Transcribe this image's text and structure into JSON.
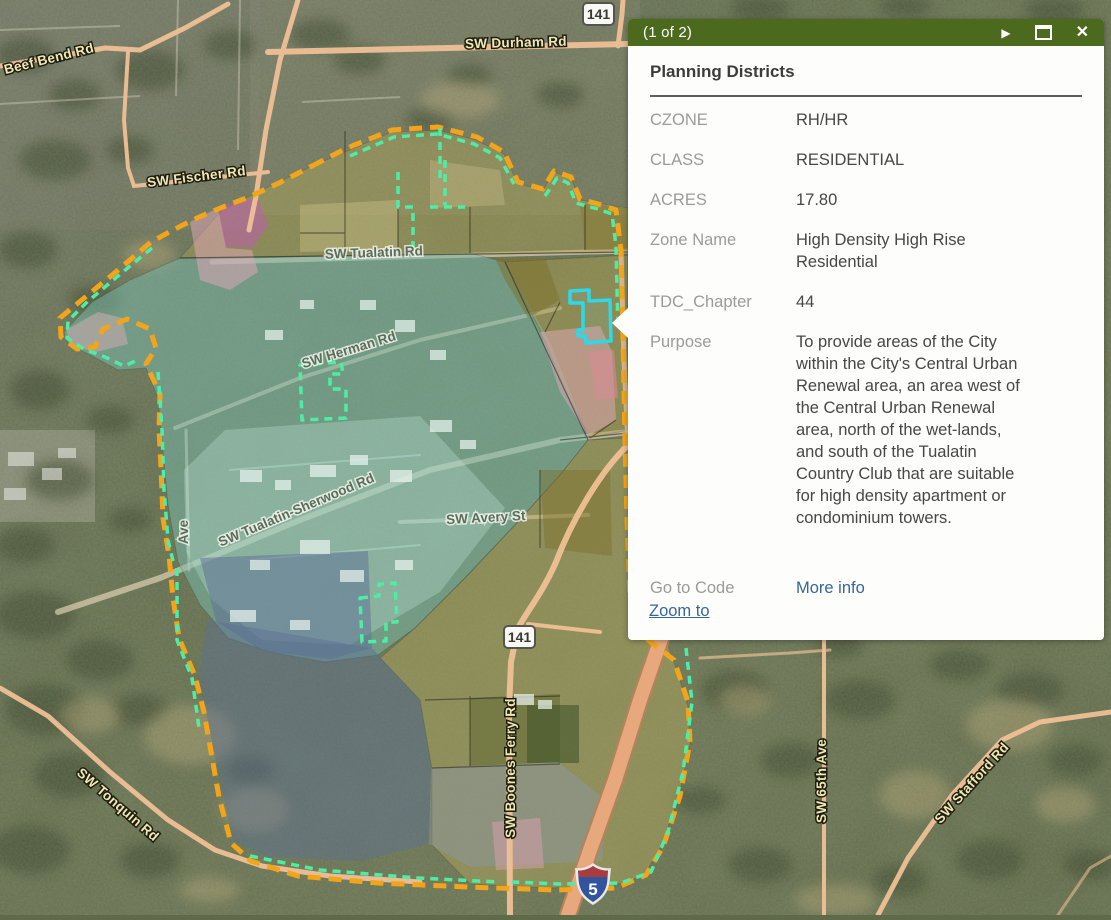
{
  "map": {
    "roads": [
      {
        "name": "beef-bend-rd",
        "text": "Beef Bend Rd"
      },
      {
        "name": "sw-durham-rd",
        "text": "SW Durham Rd"
      },
      {
        "name": "sw-fischer-rd",
        "text": "SW Fischer Rd"
      },
      {
        "name": "sw-tualatin-rd",
        "text": "SW Tualatin Rd"
      },
      {
        "name": "sw-herman-rd",
        "text": "SW Herman Rd"
      },
      {
        "name": "sw-tualatin-sherwood-rd",
        "text": "SW Tualatin-Sherwood Rd"
      },
      {
        "name": "sw-avery-st",
        "text": "SW Avery St"
      },
      {
        "name": "ave-partial",
        "text": "Ave"
      },
      {
        "name": "sw-tonquin-rd",
        "text": "SW Tonquin Rd"
      },
      {
        "name": "sw-boones-ferry-rd",
        "text": "SW Boones Ferry Rd"
      },
      {
        "name": "sw-65th-ave",
        "text": "SW 65th Ave"
      },
      {
        "name": "sw-stafford-rd",
        "text": "SW Stafford Rd"
      }
    ],
    "shields": [
      {
        "name": "route-141-north",
        "text": "141"
      },
      {
        "name": "route-141-south",
        "text": "141"
      },
      {
        "name": "interstate-5",
        "text": "5"
      }
    ]
  },
  "popup": {
    "pagination": "(1 of 2)",
    "title": "Planning Districts",
    "rows": [
      {
        "label": "CZONE",
        "value": "RH/HR"
      },
      {
        "label": "CLASS",
        "value": "RESIDENTIAL"
      },
      {
        "label": "ACRES",
        "value": "17.80"
      },
      {
        "label": "Zone Name",
        "value": "High Density High Rise Residential"
      },
      {
        "label": "TDC_Chapter",
        "value": "44"
      },
      {
        "label": "Purpose",
        "value": "To provide areas of the City within the City's Central Urban Renewal area, an area west of the Central Urban Renewal area, north of the wet-lands, and south of the Tualatin Country Club that are suitable for high density apartment or condominium towers."
      },
      {
        "label": "Go to Code",
        "value": "More info"
      }
    ],
    "footer_link": "Zoom to"
  },
  "colors": {
    "popup_header_green": "#4c6a1e",
    "link_blue": "#35679b",
    "boundary_orange": "#f2a51a",
    "zone_dash_green": "#4deda6",
    "selection_cyan": "#2bd9e9",
    "zone_teal": "#79bcae",
    "zone_olive": "#b1a556",
    "zone_pink": "#e3a8ba",
    "zone_magenta": "#bf5fae",
    "zone_slate": "#5c6e96",
    "road_salmon": "#f0c096"
  }
}
